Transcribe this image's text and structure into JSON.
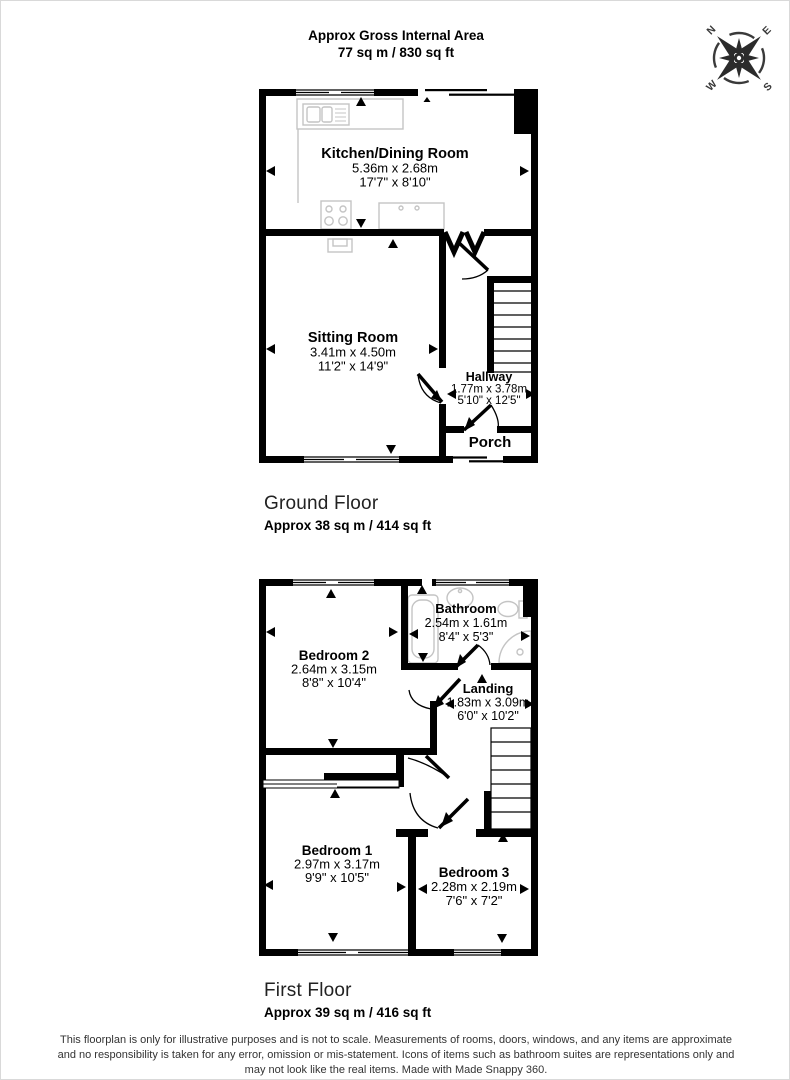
{
  "header": {
    "line1": "Approx Gross Internal Area",
    "line2": "77 sq m / 830 sq ft"
  },
  "compass": {
    "north": "N",
    "east": "E",
    "south": "S",
    "west": "W"
  },
  "ground_floor": {
    "title": "Ground Floor",
    "area": "Approx 38 sq m / 414 sq ft",
    "rooms": {
      "kitchen_dining": {
        "name": "Kitchen/Dining Room",
        "metric": "5.36m x 2.68m",
        "imperial": "17'7\" x 8'10\""
      },
      "sitting_room": {
        "name": "Sitting Room",
        "metric": "3.41m x 4.50m",
        "imperial": "11'2\" x 14'9\""
      },
      "hallway": {
        "name": "Hallway",
        "metric": "1.77m x 3.78m",
        "imperial": "5'10\" x 12'5\""
      },
      "porch": {
        "name": "Porch"
      }
    }
  },
  "first_floor": {
    "title": "First Floor",
    "area": "Approx 39 sq m / 416 sq ft",
    "rooms": {
      "bedroom2": {
        "name": "Bedroom 2",
        "metric": "2.64m x 3.15m",
        "imperial": "8'8\" x 10'4\""
      },
      "bathroom": {
        "name": "Bathroom",
        "metric": "2.54m x 1.61m",
        "imperial": "8'4\" x 5'3\""
      },
      "landing": {
        "name": "Landing",
        "metric": "1.83m x 3.09m",
        "imperial": "6'0\" x 10'2\""
      },
      "bedroom1": {
        "name": "Bedroom 1",
        "metric": "2.97m x 3.17m",
        "imperial": "9'9\" x 10'5\""
      },
      "bedroom3": {
        "name": "Bedroom 3",
        "metric": "2.28m x 2.19m",
        "imperial": "7'6\" x 7'2\""
      }
    }
  },
  "disclaimer": {
    "line1": "This floorplan is only for illustrative purposes and is not to scale. Measurements of rooms, doors, windows, and any items are approximate",
    "line2": "and no responsibility is taken for any error, omission or mis-statement. Icons of items such as bathroom suites are representations only and",
    "line3": "may not look like the real items. Made with Made Snappy 360."
  },
  "colors": {
    "wall": "#000000",
    "fixture": "#c4c4c4",
    "text": "#000000",
    "muted": "#333333"
  }
}
